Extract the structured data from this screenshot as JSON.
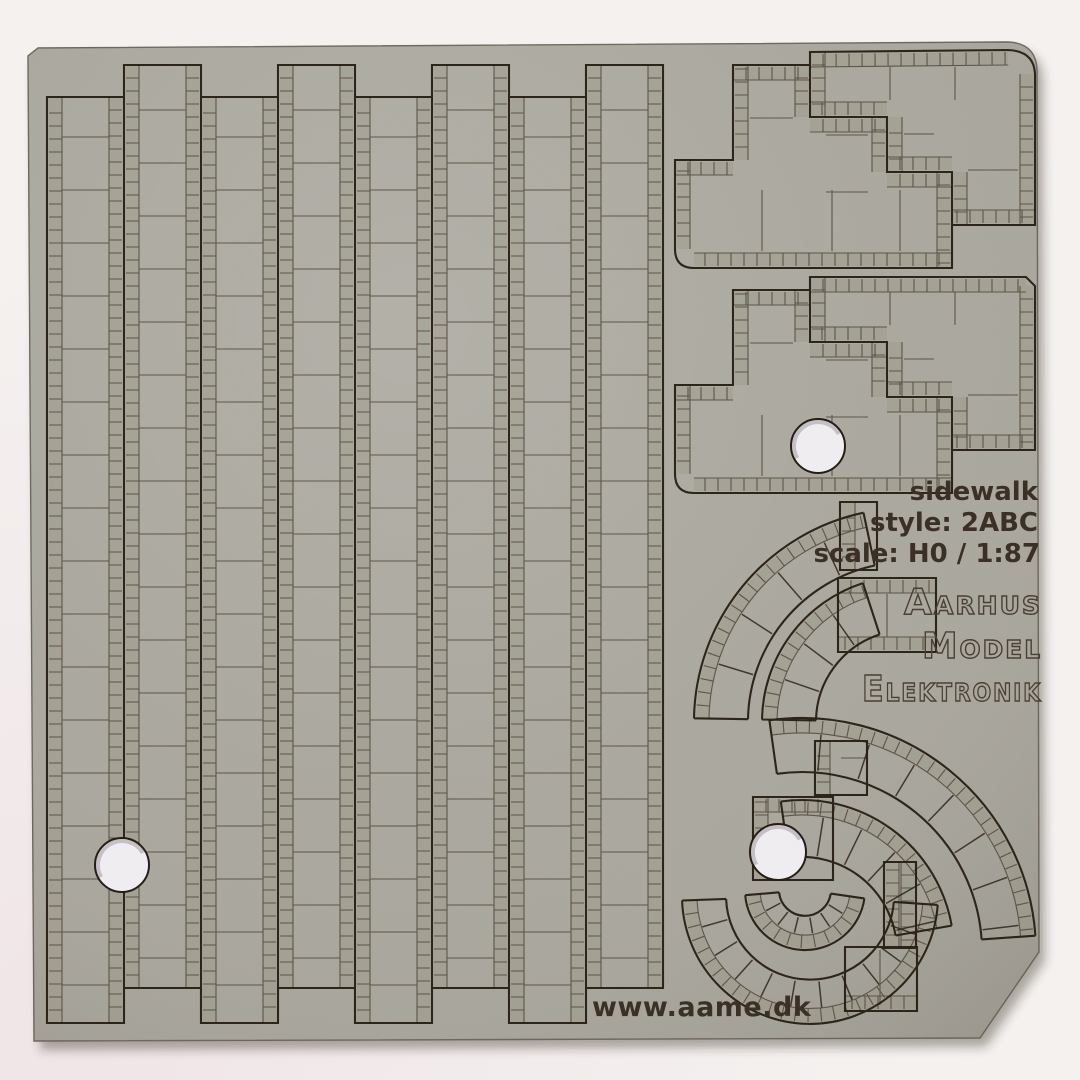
{
  "labels": {
    "product": "sidewalk",
    "style": "style: 2ABC",
    "scale": "scale: H0 / 1:87",
    "brand_line1": "Aarhus",
    "brand_line2": "Model",
    "brand_line3": "Elektronik",
    "website": "www.aame.dk"
  },
  "colors": {
    "background": "#f4f1ef",
    "background_tint": "#f1e7ea",
    "sheet": "#a9a69d",
    "sheet_light": "#b5b2a9",
    "sheet_dark": "#9d9a91",
    "brick_tint": "#94917f",
    "cut_line": "#271d13",
    "engrave_line": "#52463a",
    "text": "#3a3025",
    "brand_stroke": "#4b3f33",
    "shadow": "rgba(45,36,28,0.38)",
    "hole_fill": "#efedef",
    "edge": "#6a645a"
  },
  "board": {
    "width": 1080,
    "height": 1080,
    "strips": {
      "count": 8,
      "first_x": 47,
      "width": 77,
      "brick": 13,
      "slab_step": 53,
      "tall_top": 65,
      "short_top": 97,
      "tall_bottom": 988,
      "short_bottom": 1023
    },
    "holes": [
      {
        "x": 122,
        "y": 865,
        "r": 27
      },
      {
        "x": 818,
        "y": 446,
        "r": 27
      },
      {
        "x": 778,
        "y": 852,
        "r": 28
      }
    ]
  }
}
